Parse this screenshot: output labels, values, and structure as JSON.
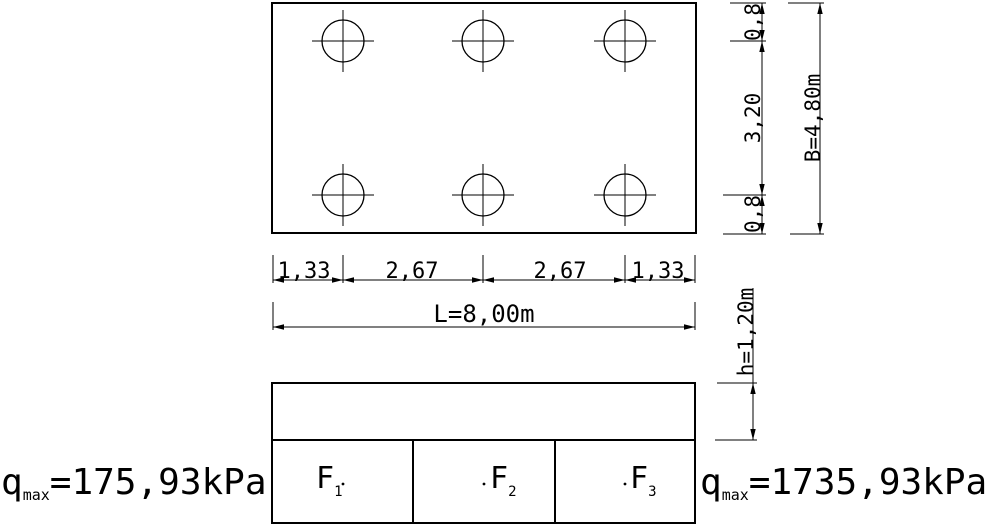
{
  "colors": {
    "line": "#000000",
    "background": "#ffffff"
  },
  "plan_view": {
    "dim_chain_labels": [
      "1,33",
      "2,67",
      "2,67",
      "1,33"
    ],
    "dim_length_label": "L=8,00m",
    "dim_width_segment_labels": [
      "0,8",
      "3,20",
      "0,8"
    ],
    "dim_width_label": "B=4,80m"
  },
  "elevation_view": {
    "dim_height_label": "h=1,20m",
    "footings": [
      {
        "symbol": "F",
        "subscript": "1"
      },
      {
        "symbol": "F",
        "subscript": "2"
      },
      {
        "symbol": "F",
        "subscript": "3"
      }
    ]
  },
  "pressure_annotations": {
    "left": {
      "symbol": "q",
      "subscript": "max",
      "value": "=175,93kPa"
    },
    "right": {
      "symbol": "q",
      "subscript": "max",
      "value": "=1735,93kPa"
    }
  }
}
